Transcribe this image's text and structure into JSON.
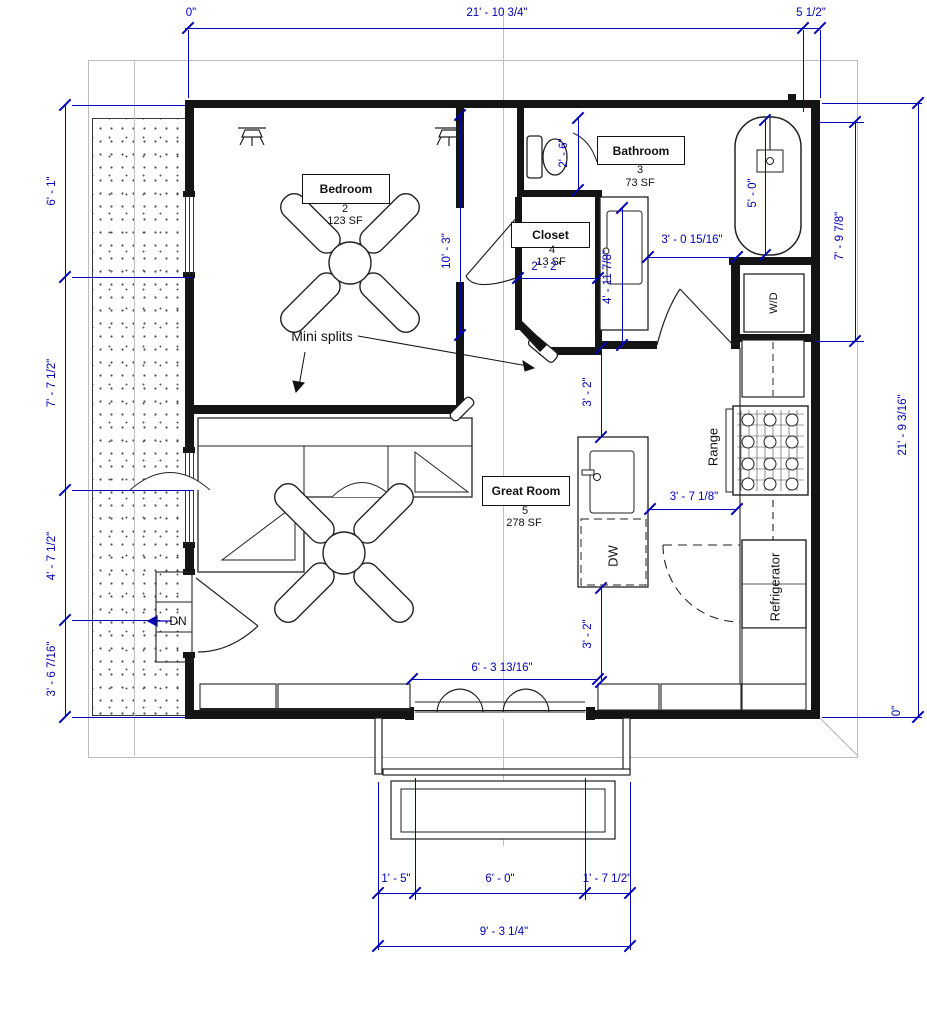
{
  "colors": {
    "dimension_blue": "#0000b4",
    "wall_black": "#141414",
    "sheet_gray": "#bcbcbc"
  },
  "rooms": {
    "bedroom": {
      "name": "Bedroom",
      "number": "2",
      "area": "123 SF"
    },
    "bathroom": {
      "name": "Bathroom",
      "number": "3",
      "area": "73 SF"
    },
    "closet": {
      "name": "Closet",
      "number": "4",
      "area": "13 SF"
    },
    "great_room": {
      "name": "Great Room",
      "number": "5",
      "area": "278 SF"
    }
  },
  "appliances": {
    "range": "Range",
    "refrigerator": "Refrigerator",
    "dishwasher": "DW",
    "washer_dryer": "W/D"
  },
  "annotations": {
    "mini_splits": "Mini splits",
    "down": "DN"
  },
  "dimensions": {
    "top": {
      "zero": "0\"",
      "width": "21' - 10 3/4\"",
      "offset": "5 1/2\""
    },
    "left": {
      "d1": "6' - 1\"",
      "d2": "7' - 7 1/2\"",
      "d3": "4' - 7 1/2\"",
      "d4": "3' - 6 7/16\""
    },
    "right": {
      "upper": "7' - 9 7/8\"",
      "total": "21' - 9 3/16\"",
      "zero": "0\""
    },
    "bottom": {
      "left": "1' - 5\"",
      "center": "6' - 0\"",
      "right": "1' - 7 1/2\"",
      "total": "9' - 3 1/4\""
    },
    "interior": {
      "toilet": "2' - 6\"",
      "bedroom": "10' - 3\"",
      "closet": "2' - 2\"",
      "bath_clear": "3' - 0 15/16\"",
      "vanity": "4' - 11 7/8\"",
      "tub": "5' - 0\"",
      "island_top": "3' - 2\"",
      "island_range": "3' - 7 1/8\"",
      "island_bottom": "3' - 2\"",
      "entry": "6' - 3 13/16\""
    }
  }
}
